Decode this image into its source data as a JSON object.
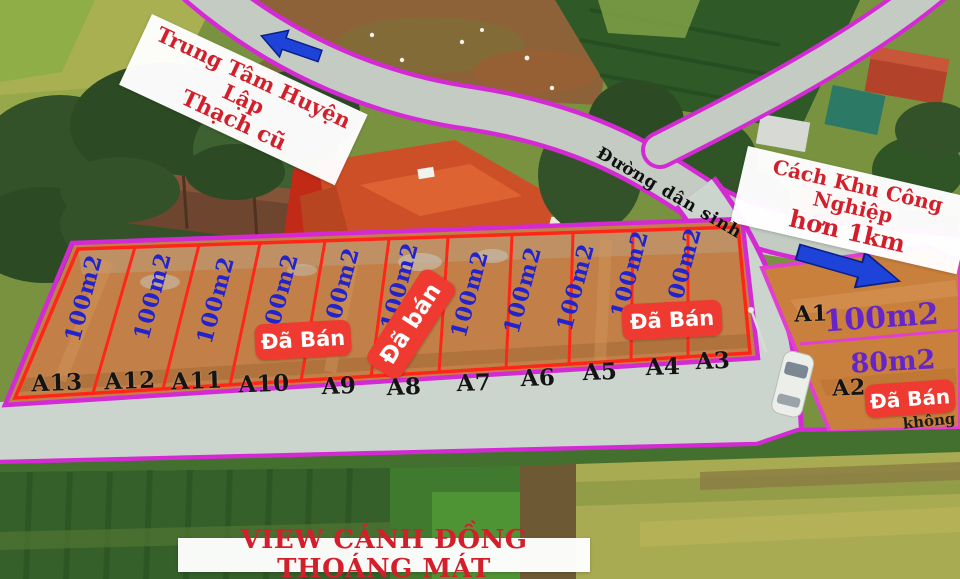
{
  "annotations": {
    "town_direction": {
      "line1": "Trung Tâm Huyện Lập",
      "line2": "Thạch cũ"
    },
    "industrial_direction": {
      "line1": "Cách Khu Công Nghiệp",
      "line2": "hơn 1km"
    },
    "road_name": "Đường dân sinh",
    "bottom_banner": "VIEW CÁNH ĐỒNG THOÁNG MÁT",
    "note_fragment": "không",
    "sold_banner_a10_a9": "Đã Bán",
    "sold_banner_a8": "Đã bán",
    "sold_banner_a4_a3": "Đã Bán",
    "sold_banner_a2": "Đã Bán"
  },
  "plots": {
    "strip": [
      {
        "id": "A13",
        "area": "100m2",
        "sold": false
      },
      {
        "id": "A12",
        "area": "100m2",
        "sold": false
      },
      {
        "id": "A11",
        "area": "100m2",
        "sold": false
      },
      {
        "id": "A10",
        "area": "100m2",
        "sold": true
      },
      {
        "id": "A9",
        "area": "100m2",
        "sold": true
      },
      {
        "id": "A8",
        "area": "100m2",
        "sold": true
      },
      {
        "id": "A7",
        "area": "100m2",
        "sold": false
      },
      {
        "id": "A6",
        "area": "100m2",
        "sold": false
      },
      {
        "id": "A5",
        "area": "100m2",
        "sold": false
      },
      {
        "id": "A4",
        "area": "100m2",
        "sold": true
      },
      {
        "id": "A3",
        "area": "100m2",
        "sold": true
      }
    ],
    "corner": [
      {
        "id": "A1",
        "area": "100m2",
        "sold": false
      },
      {
        "id": "A2",
        "area": "80m2",
        "sold": true
      }
    ]
  },
  "icons": {
    "town_arrow": "arrow-up-left",
    "industrial_arrow": "arrow-down-right",
    "car": "white-car-top-view"
  },
  "colors": {
    "site_outline": "#d42ad4",
    "plot_outline": "#ff2617",
    "area_text_blue": "#2323cd",
    "area_text_purple": "#6426c9",
    "sold_banner_bg": "#ee3a30",
    "sold_banner_text": "#ffffff",
    "direction_text": "#d31f2b",
    "arrow_blue": "#1e43d8"
  }
}
